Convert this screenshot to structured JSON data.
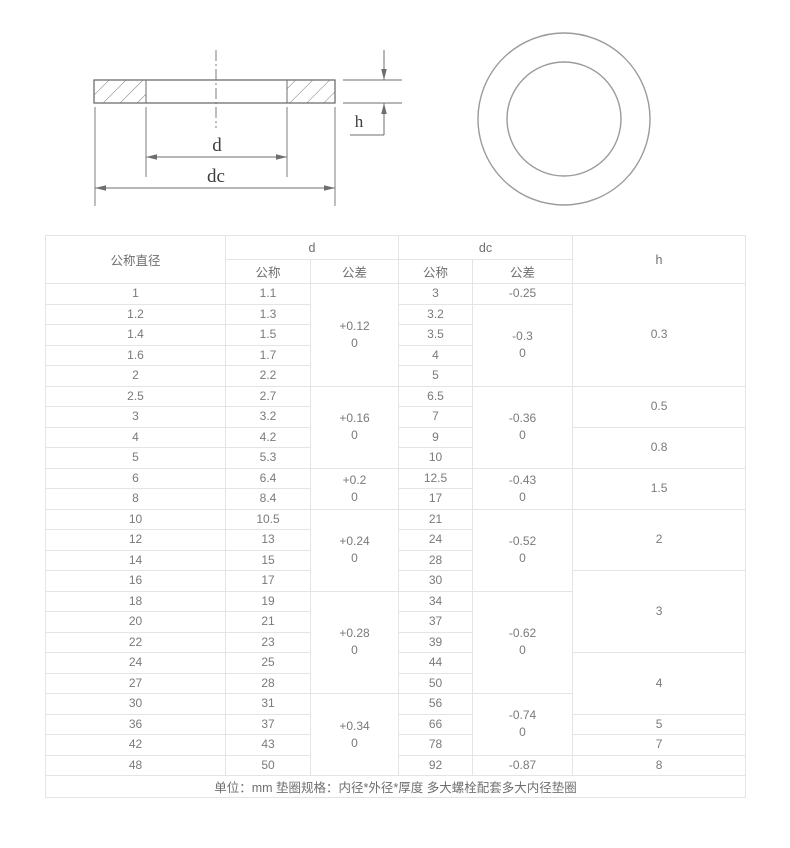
{
  "diagram": {
    "d_label": "d",
    "dc_label": "dc",
    "h_label": "h",
    "line_color": "#6e6e6e",
    "circle_color": "#9b9b9b"
  },
  "table": {
    "header": {
      "col1": "公称直径",
      "d": "d",
      "dc": "dc",
      "h": "h",
      "sub_nominal": "公称",
      "sub_tolerance": "公差"
    },
    "rows": [
      {
        "nominal": "1",
        "d_nom": "1.1",
        "dc_nom": "3"
      },
      {
        "nominal": "1.2",
        "d_nom": "1.3",
        "dc_nom": "3.2"
      },
      {
        "nominal": "1.4",
        "d_nom": "1.5",
        "dc_nom": "3.5"
      },
      {
        "nominal": "1.6",
        "d_nom": "1.7",
        "dc_nom": "4"
      },
      {
        "nominal": "2",
        "d_nom": "2.2",
        "dc_nom": "5"
      },
      {
        "nominal": "2.5",
        "d_nom": "2.7",
        "dc_nom": "6.5"
      },
      {
        "nominal": "3",
        "d_nom": "3.2",
        "dc_nom": "7"
      },
      {
        "nominal": "4",
        "d_nom": "4.2",
        "dc_nom": "9"
      },
      {
        "nominal": "5",
        "d_nom": "5.3",
        "dc_nom": "10"
      },
      {
        "nominal": "6",
        "d_nom": "6.4",
        "dc_nom": "12.5"
      },
      {
        "nominal": "8",
        "d_nom": "8.4",
        "dc_nom": "17"
      },
      {
        "nominal": "10",
        "d_nom": "10.5",
        "dc_nom": "21"
      },
      {
        "nominal": "12",
        "d_nom": "13",
        "dc_nom": "24"
      },
      {
        "nominal": "14",
        "d_nom": "15",
        "dc_nom": "28"
      },
      {
        "nominal": "16",
        "d_nom": "17",
        "dc_nom": "30"
      },
      {
        "nominal": "18",
        "d_nom": "19",
        "dc_nom": "34"
      },
      {
        "nominal": "20",
        "d_nom": "21",
        "dc_nom": "37"
      },
      {
        "nominal": "22",
        "d_nom": "23",
        "dc_nom": "39"
      },
      {
        "nominal": "24",
        "d_nom": "25",
        "dc_nom": "44"
      },
      {
        "nominal": "27",
        "d_nom": "28",
        "dc_nom": "50"
      },
      {
        "nominal": "30",
        "d_nom": "31",
        "dc_nom": "56"
      },
      {
        "nominal": "36",
        "d_nom": "37",
        "dc_nom": "66"
      },
      {
        "nominal": "42",
        "d_nom": "43",
        "dc_nom": "78"
      },
      {
        "nominal": "48",
        "d_nom": "50",
        "dc_nom": "92"
      }
    ],
    "d_tol": [
      {
        "row": 0,
        "span": 5,
        "line1": "+0.12",
        "line2": "0"
      },
      {
        "row": 5,
        "span": 4,
        "line1": "+0.16",
        "line2": "0"
      },
      {
        "row": 9,
        "span": 2,
        "line1": "+0.2",
        "line2": "0"
      },
      {
        "row": 11,
        "span": 4,
        "line1": "+0.24",
        "line2": "0"
      },
      {
        "row": 15,
        "span": 5,
        "line1": "+0.28",
        "line2": "0"
      },
      {
        "row": 20,
        "span": 4,
        "line1": "+0.34",
        "line2": "0"
      }
    ],
    "dc_tol": [
      {
        "row": 0,
        "span": 1,
        "line1": "-0.25",
        "line2": null
      },
      {
        "row": 1,
        "span": 4,
        "line1": "-0.3",
        "line2": "0"
      },
      {
        "row": 5,
        "span": 4,
        "line1": "-0.36",
        "line2": "0"
      },
      {
        "row": 9,
        "span": 2,
        "line1": "-0.43",
        "line2": "0"
      },
      {
        "row": 11,
        "span": 4,
        "line1": "-0.52",
        "line2": "0"
      },
      {
        "row": 15,
        "span": 5,
        "line1": "-0.62",
        "line2": "0"
      },
      {
        "row": 20,
        "span": 3,
        "line1": "-0.74",
        "line2": "0"
      },
      {
        "row": 23,
        "span": 1,
        "line1": "-0.87",
        "line2": null
      }
    ],
    "h_col": [
      {
        "row": 0,
        "span": 5,
        "value": "0.3"
      },
      {
        "row": 5,
        "span": 2,
        "value": "0.5"
      },
      {
        "row": 7,
        "span": 2,
        "value": "0.8"
      },
      {
        "row": 9,
        "span": 2,
        "value": "1.5"
      },
      {
        "row": 11,
        "span": 3,
        "value": "2"
      },
      {
        "row": 14,
        "span": 4,
        "value": "3"
      },
      {
        "row": 18,
        "span": 3,
        "value": "4"
      },
      {
        "row": 21,
        "span": 1,
        "value": "5"
      },
      {
        "row": 22,
        "span": 1,
        "value": "7"
      },
      {
        "row": 23,
        "span": 1,
        "value": "8"
      }
    ],
    "footer": "单位：mm 垫圈规格：内径*外径*厚度 多大螺栓配套多大内径垫圈"
  }
}
